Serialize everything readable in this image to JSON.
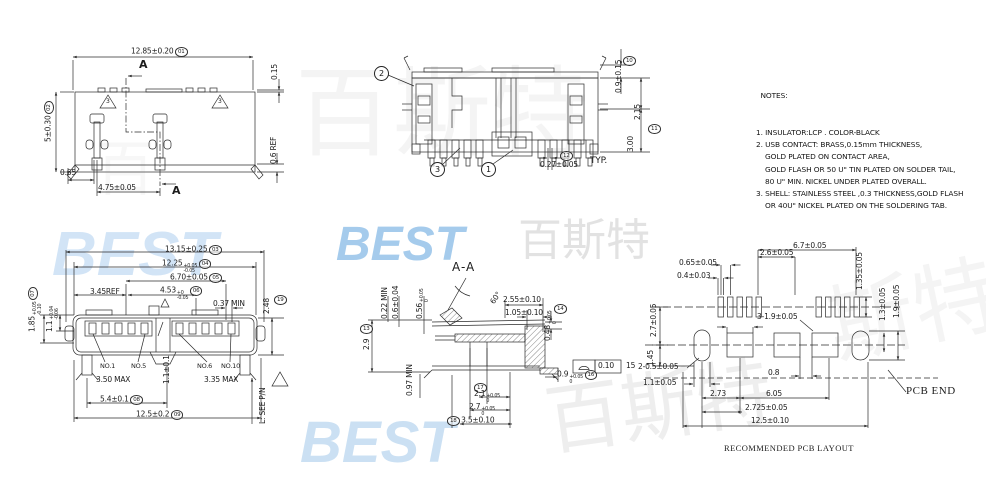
{
  "notes": {
    "title": "  NOTES:",
    "lines": [
      "1. INSULATOR:LCP . COLOR-BLACK",
      "2. USB CONTACT: BRASS,0.15mm THICKNESS,",
      "    GOLD PLATED ON CONTACT AREA,",
      "    GOLD FLASH OR 50 U\" TIN PLATED ON SOLDER TAIL,",
      "    80 U\" MIN. NICKEL UNDER PLATED OVERALL.",
      "3. SHELL: STAINLESS STEEL ,0.3 THICKNESS,GOLD FLASH",
      "    OR 40U\" NICKEL PLATED ON THE SOLDERING TAB."
    ]
  },
  "watermarks": [
    {
      "t": "BEST",
      "x": 52,
      "y": 224,
      "s": 62,
      "c": "#aecff0",
      "o": 0.55,
      "blue": true
    },
    {
      "t": "BEST",
      "x": 336,
      "y": 221,
      "s": 48,
      "c": "#8fbfe8",
      "o": 0.8,
      "blue": true
    },
    {
      "t": "百斯特",
      "x": 518,
      "y": 219,
      "s": 44,
      "c": "#dedede",
      "o": 0.85
    },
    {
      "t": "百斯特",
      "x": 295,
      "y": 64,
      "s": 98,
      "c": "#ececec",
      "o": 0.55
    },
    {
      "t": "BEST",
      "x": 300,
      "y": 414,
      "s": 58,
      "c": "#a9cdec",
      "o": 0.6,
      "blue": true
    },
    {
      "t": "百斯特",
      "x": 545,
      "y": 370,
      "s": 76,
      "c": "#e7e7e7",
      "o": 0.7,
      "r": -8
    },
    {
      "t": "斯特",
      "x": 828,
      "y": 268,
      "s": 86,
      "c": "#ededed",
      "o": 0.6,
      "r": -12
    },
    {
      "t": "百",
      "x": 95,
      "y": 140,
      "s": 60,
      "c": "#f1f1f1",
      "o": 0.5
    }
  ],
  "balloons": [
    {
      "n": "balloon-2",
      "t": "2",
      "x": 374,
      "y": 66
    },
    {
      "n": "balloon-3",
      "t": "3",
      "x": 430,
      "y": 162
    },
    {
      "n": "balloon-1",
      "t": "1",
      "x": 481,
      "y": 162
    }
  ],
  "labels": [
    {
      "n": "dim-overall-width",
      "t": "12.85±0.20",
      "id": "01",
      "x": 131,
      "y": 47
    },
    {
      "n": "dim-shell-lip",
      "t": "0.15",
      "r": -90,
      "x": 271,
      "y": 80
    },
    {
      "n": "dim-overall-depth",
      "t": "5±0.30",
      "id": "02",
      "r": -90,
      "x": 44,
      "y": 142
    },
    {
      "n": "dim-ref-height",
      "t": "0.6 REF",
      "r": -90,
      "x": 270,
      "y": 164
    },
    {
      "n": "dim-tab-offset",
      "t": "0.65",
      "x": 60,
      "y": 169
    },
    {
      "n": "dim-tab-pitch",
      "t": "4.75±0.05",
      "x": 98,
      "y": 184
    },
    {
      "n": "section-arrow-label-top",
      "t": "A",
      "c": "big",
      "x": 139,
      "y": 59
    },
    {
      "n": "section-arrow-label-bottom",
      "t": "A",
      "c": "big",
      "x": 172,
      "y": 185
    },
    {
      "n": "note-flag-number",
      "t": "3",
      "c": "tri-num",
      "x": 106,
      "y": 99
    },
    {
      "n": "note-flag-number",
      "t": "3",
      "c": "tri-num",
      "x": 218,
      "y": 99
    },
    {
      "n": "dim-cover-height",
      "t": "0.9±0.15",
      "r": -90,
      "x": 615,
      "y": 93
    },
    {
      "n": "dim-id",
      "t": "10",
      "c": "oval",
      "x": 623,
      "y": 56
    },
    {
      "n": "dim-step-height",
      "t": "2.15",
      "r": -90,
      "x": 634,
      "y": 120
    },
    {
      "n": "dim-body-height",
      "t": "3.00",
      "r": -90,
      "x": 627,
      "y": 152
    },
    {
      "n": "dim-id",
      "t": "11",
      "c": "oval",
      "x": 648,
      "y": 124
    },
    {
      "n": "dim-id",
      "t": "12",
      "c": "oval",
      "x": 560,
      "y": 151
    },
    {
      "n": "dim-tail-width",
      "t": "0.27±0.05",
      "x": 540,
      "y": 161
    },
    {
      "n": "typ-suffix",
      "t": "TYP.",
      "c": "mid",
      "x": 590,
      "y": 157
    },
    {
      "n": "dim-flange-width",
      "t": "13.15±0.25",
      "id": "03",
      "x": 165,
      "y": 245
    },
    {
      "n": "dim-shell-width",
      "t": "12.25",
      "u": "+0.05",
      "d": "-0.05",
      "id": "04",
      "x": 162,
      "y": 259
    },
    {
      "n": "dim-port-span",
      "t": "6.70±0.05",
      "id": "05",
      "x": 170,
      "y": 273
    },
    {
      "n": "dim-ref",
      "t": "3.45REF",
      "x": 90,
      "y": 288
    },
    {
      "n": "dim-key-offset",
      "t": "4.53",
      "u": "+0",
      "d": "-0.05",
      "id": "06",
      "x": 160,
      "y": 286
    },
    {
      "n": "dim-min-gap",
      "t": "0.37 MIN",
      "x": 213,
      "y": 300
    },
    {
      "n": "dim-shell-band",
      "t": "1.85",
      "u": "+0.05",
      "d": "-0.10",
      "id": "07",
      "r": -90,
      "x": 28,
      "y": 332
    },
    {
      "n": "dim-lip",
      "t": "1.1",
      "u": "+0.04",
      "d": "-0.06",
      "r": -90,
      "x": 46,
      "y": 332
    },
    {
      "n": "dim-height",
      "t": "2.48",
      "r": -90,
      "x": 263,
      "y": 314
    },
    {
      "n": "dim-id",
      "t": "19",
      "c": "oval",
      "x": 274,
      "y": 295
    },
    {
      "n": "pin-label",
      "t": "NO.1",
      "c": "tiny2",
      "x": 100,
      "y": 363
    },
    {
      "n": "pin-label",
      "t": "NO.5",
      "c": "tiny2",
      "x": 131,
      "y": 363
    },
    {
      "n": "pin-label",
      "t": "NO.6",
      "c": "tiny2",
      "x": 197,
      "y": 363
    },
    {
      "n": "pin-label",
      "t": "NO.10",
      "c": "tiny2",
      "x": 221,
      "y": 363
    },
    {
      "n": "dim-max",
      "t": "3.50 MAX",
      "x": 96,
      "y": 376
    },
    {
      "n": "dim-max",
      "t": "3.35 MAX",
      "x": 204,
      "y": 376
    },
    {
      "n": "dim-key-width",
      "t": "1.1±0.1",
      "r": -90,
      "x": 163,
      "y": 384
    },
    {
      "n": "dim-post-span",
      "t": "5.4±0.1",
      "id": "08",
      "x": 100,
      "y": 395
    },
    {
      "n": "dim-post-outer",
      "t": "12.5±0.2",
      "id": "09",
      "x": 136,
      "y": 410
    },
    {
      "n": "length-note",
      "t": "L: SEE P/N",
      "r": -90,
      "x": 259,
      "y": 424
    },
    {
      "n": "section-title",
      "t": "A-A",
      "c": "sec",
      "x": 452,
      "y": 261
    },
    {
      "n": "dim-angle",
      "t": "60°",
      "r": -55,
      "x": 489,
      "y": 301
    },
    {
      "n": "dim-latch",
      "t": "2.55±0.10",
      "x": 503,
      "y": 296
    },
    {
      "n": "dim-latch2",
      "t": "1.05±0.10",
      "x": 505,
      "y": 309
    },
    {
      "n": "dim-lip2",
      "t": "0.48",
      "u": "+0.05",
      "d": "0",
      "r": -90,
      "x": 544,
      "y": 341
    },
    {
      "n": "dim-id",
      "t": "14",
      "c": "oval",
      "x": 554,
      "y": 304
    },
    {
      "n": "dim-min2",
      "t": "0.22 MIN",
      "r": -90,
      "x": 381,
      "y": 319
    },
    {
      "n": "dim-contact",
      "t": "0.6±0.04",
      "r": -90,
      "x": 392,
      "y": 319
    },
    {
      "n": "dim-gap2",
      "t": "0.56",
      "u": "+0.05",
      "d": "0",
      "r": -90,
      "x": 416,
      "y": 319
    },
    {
      "n": "dim-section-height",
      "t": "2.9",
      "r": -90,
      "x": 363,
      "y": 350
    },
    {
      "n": "dim-id",
      "t": "13",
      "c": "oval",
      "x": 360,
      "y": 324
    },
    {
      "n": "dim-min3",
      "t": "0.97 MIN",
      "r": -90,
      "x": 406,
      "y": 396
    },
    {
      "n": "fcf-value",
      "t": "0.10",
      "x": 598,
      "y": 362
    },
    {
      "n": "fcf-ref",
      "t": "15",
      "x": 626,
      "y": 362
    },
    {
      "n": "dim-tab-height",
      "t": "0.9",
      "u": "+0.05",
      "d": "0",
      "id": "16",
      "x": 557,
      "y": 370
    },
    {
      "n": "dim-id",
      "t": "17",
      "c": "oval",
      "x": 474,
      "y": 383
    },
    {
      "n": "dim-depth1",
      "t": "2.1",
      "u": "+0.05",
      "d": "0",
      "x": 474,
      "y": 390
    },
    {
      "n": "dim-depth2",
      "t": "2.7",
      "u": "+0.05",
      "d": "0",
      "x": 469,
      "y": 403
    },
    {
      "n": "dim-depth3",
      "t": "3.5±0.10",
      "id": "18",
      "ip": "before",
      "x": 447,
      "y": 416
    },
    {
      "n": "dim-pad-span",
      "t": "6.7±0.05",
      "x": 793,
      "y": 242
    },
    {
      "n": "dim-pad-span2",
      "t": "2.6±0.05",
      "x": 760,
      "y": 249
    },
    {
      "n": "dim-pad-pitch",
      "t": "0.65±0.05",
      "x": 679,
      "y": 259
    },
    {
      "n": "dim-pad-width",
      "t": "0.4±0.03",
      "x": 677,
      "y": 272
    },
    {
      "n": "dim-pad-height",
      "t": "1.35±0.05",
      "r": -90,
      "x": 856,
      "y": 290
    },
    {
      "n": "dim-hole-h",
      "t": "1.9±0.05",
      "r": -90,
      "x": 893,
      "y": 318
    },
    {
      "n": "dim-hole-h2",
      "t": "1.3±0.05",
      "r": -90,
      "x": 879,
      "y": 321
    },
    {
      "n": "dim-row-gap",
      "t": "2.7±0.05",
      "r": -90,
      "x": 650,
      "y": 337
    },
    {
      "n": "dim-row-gap2",
      "t": "1.45",
      "r": -90,
      "x": 647,
      "y": 366
    },
    {
      "n": "dim-pads3",
      "t": "3-1.9±0.05",
      "x": 757,
      "y": 313
    },
    {
      "n": "dim-slots2",
      "t": "2-0.5±0.05",
      "x": 638,
      "y": 363
    },
    {
      "n": "dim-slot-w",
      "t": "1.1±0.05",
      "x": 643,
      "y": 379
    },
    {
      "n": "dim-273",
      "t": "2.73",
      "x": 710,
      "y": 390
    },
    {
      "n": "dim-08",
      "t": "0.8",
      "x": 768,
      "y": 369
    },
    {
      "n": "dim-605",
      "t": "6.05",
      "x": 766,
      "y": 390
    },
    {
      "n": "dim-2725",
      "t": "2.725±0.05",
      "x": 745,
      "y": 404
    },
    {
      "n": "dim-125",
      "t": "12.5±0.10",
      "x": 751,
      "y": 417
    },
    {
      "n": "pcb-end-label",
      "t": "PCB END",
      "c": "serif",
      "x": 906,
      "y": 385
    },
    {
      "n": "pcb-caption",
      "t": "RECOMMENDED PCB LAYOUT",
      "c": "serifsm",
      "x": 724,
      "y": 444
    }
  ]
}
